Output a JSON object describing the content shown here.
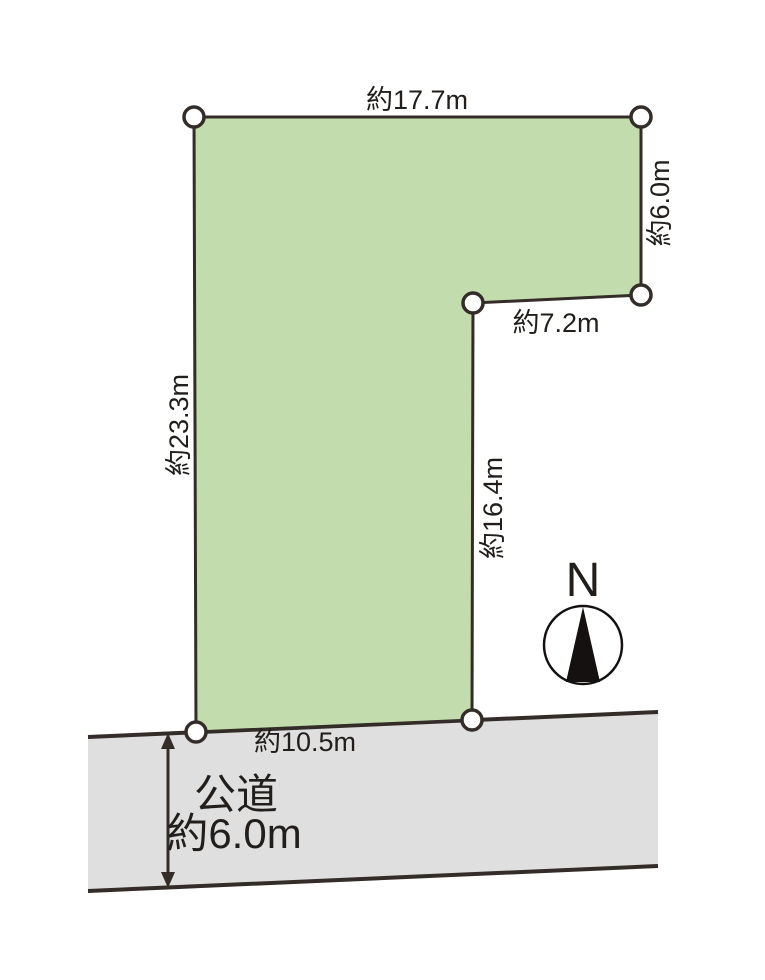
{
  "diagram": {
    "type": "land-plot-site-plan",
    "background_color": "#ffffff",
    "line_color": "#332c28",
    "plot": {
      "fill_color": "#c3dcae",
      "dimensions": {
        "top": "約17.7m",
        "upper_right": "約6.0m",
        "notch": "約7.2m",
        "inner_right": "約16.4m",
        "left": "約23.3m",
        "frontage_bottom": "約10.5m"
      }
    },
    "road": {
      "fill_color": "#dfdfdf",
      "name": "公道",
      "width": "約6.0m"
    },
    "compass": {
      "north_label": "N"
    }
  }
}
